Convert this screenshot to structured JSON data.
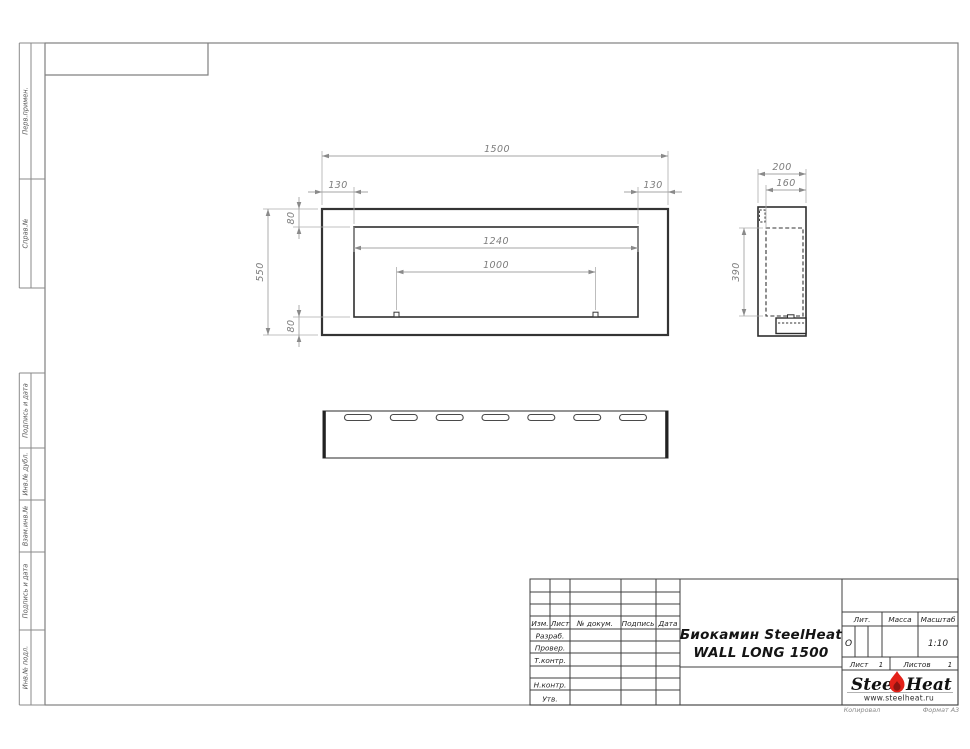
{
  "margin_labels": {
    "perv_primen": "Перв.примен.",
    "sprav_no": "Справ.№",
    "podpis_data_1": "Подпись и дата",
    "inv_dubl": "Инв.№ дубл.",
    "vzam_inv": "Взам.инв.№",
    "podpis_data_2": "Подпись и дата",
    "inv_podl": "Инв.№ подл."
  },
  "front_view": {
    "dim_width_total": "1500",
    "dim_offset_left": "130",
    "dim_offset_right": "130",
    "dim_border_top": "80",
    "dim_border_bottom": "80",
    "dim_height_total": "550",
    "dim_opening_width": "1240",
    "dim_burner_width": "1000"
  },
  "side_view": {
    "dim_depth_total": "200",
    "dim_depth_inner": "160",
    "dim_height_inner": "390"
  },
  "title_block": {
    "col_izm": "Изм.",
    "col_list": "Лист",
    "col_ndocum": "№ докум.",
    "col_podpis": "Подпись",
    "col_data": "Дата",
    "row_razrab": "Разраб.",
    "row_prover": "Провер.",
    "row_tkontr": "Т.контр.",
    "row_nkontr": "Н.контр.",
    "row_utv": "Утв.",
    "title_line1": "Биокамин SteelHeat",
    "title_line2": "WALL LONG 1500",
    "lit_label": "Лит.",
    "lit_value": "О",
    "massa_label": "Масса",
    "masshtab_label": "Масштаб",
    "masshtab_value": "1:10",
    "list_label": "Лист",
    "list_value": "1",
    "listov_label": "Листов",
    "listov_value": "1"
  },
  "logo": {
    "steel": "Steel",
    "heat": "Heat",
    "url": "www.steelheat.ru"
  },
  "footer": {
    "copied": "Копировал",
    "format": "Формат А3"
  }
}
